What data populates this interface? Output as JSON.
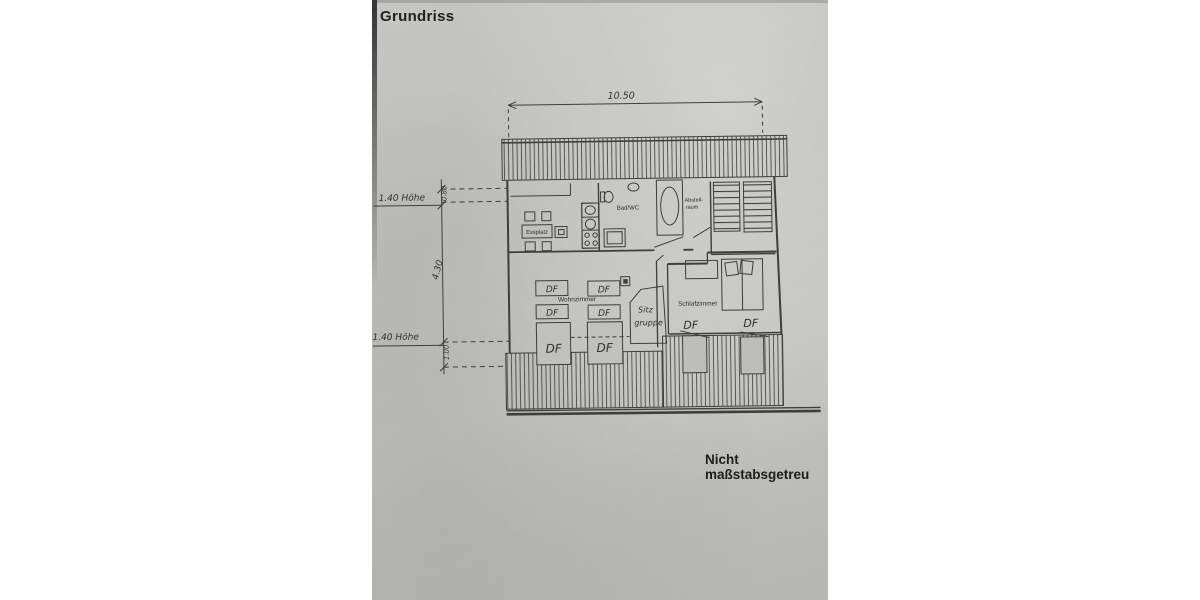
{
  "document": {
    "title": "Grundriss",
    "footnote": "Nicht maßstabsgetreu"
  },
  "plan": {
    "rooms": {
      "essplatz": "Essplatz",
      "bad_wc": "Bad/WC",
      "abstellraum_line1": "Abstell-",
      "abstellraum_line2": "raum",
      "wohnzimmer": "Wohnzimmer",
      "schlafzimmer": "Schlafzimmer",
      "sitzgruppe_line1": "Sitz",
      "sitzgruppe_line2": "gruppe"
    },
    "dimensions": {
      "total_width": "10.50",
      "depth": "4.30",
      "upper_offset": "0.80",
      "lower_offset": "1.00",
      "height_note_upper": "1.40 Höhe",
      "height_note_lower": "1.40 Höhe"
    },
    "roof_windows": {
      "df_wohnzimmer_1": "DF",
      "df_wohnzimmer_2": "DF",
      "df_wohnzimmer_3": "DF",
      "df_wohnzimmer_4": "DF",
      "df_wohnzimmer_5": "DF",
      "df_wohnzimmer_6": "DF",
      "df_schlafzimmer_1": "DF",
      "df_schlafzimmer_2": "DF"
    },
    "colors": {
      "paper": "#c0c0be",
      "ink": "#3c3c3c",
      "label_text": "#262626"
    }
  }
}
